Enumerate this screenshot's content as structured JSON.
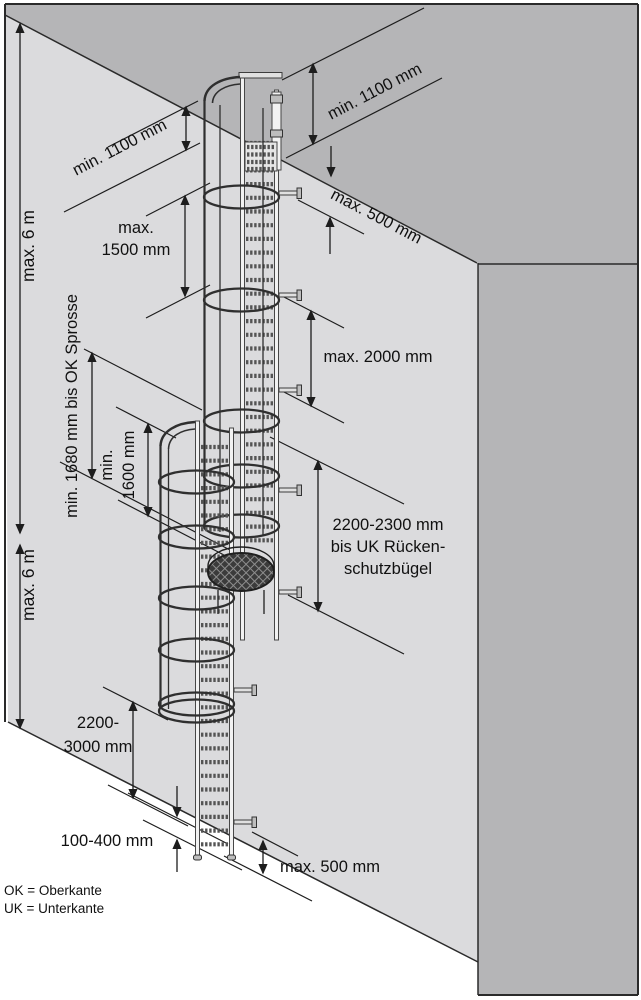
{
  "figure": {
    "type": "technical-dimension-diagram",
    "subject": "Multi-flight fixed vertical ladder with safety cage (Steigleiter mit Rückenschutz) mounted on a building wall",
    "colors": {
      "background": "#ffffff",
      "front_wall": "#dbdbdd",
      "roof_and_side_wall": "#b5b5b7",
      "outline": "#2a2a2a",
      "platform_fill": "#3b3b3b",
      "text": "#111111"
    },
    "annotations": {
      "max6_upper": "max. 6 m",
      "max6_lower": "max. 6 m",
      "min1100_left": "min. 1100 mm",
      "min1100_right": "min. 1100 mm",
      "max500_top": "max. 500 mm",
      "max1500_line1": "max.",
      "max1500_line2": "1500 mm",
      "max2000": "max. 2000 mm",
      "min1680": "min. 1680 mm bis OK Sprosse",
      "min1600_line1": "min.",
      "min1600_line2": "1600 mm",
      "cage_clearance_line1": "2200-2300 mm",
      "cage_clearance_line2": "bis UK Rücken-",
      "cage_clearance_line3": "schutzbügel",
      "exit_height_line1": "2200-",
      "exit_height_line2": "3000 mm",
      "ground_gap": "100-400 mm",
      "max500_bottom": "max. 500 mm",
      "legend_line1": "OK = Oberkante",
      "legend_line2": "UK = Unterkante"
    }
  }
}
